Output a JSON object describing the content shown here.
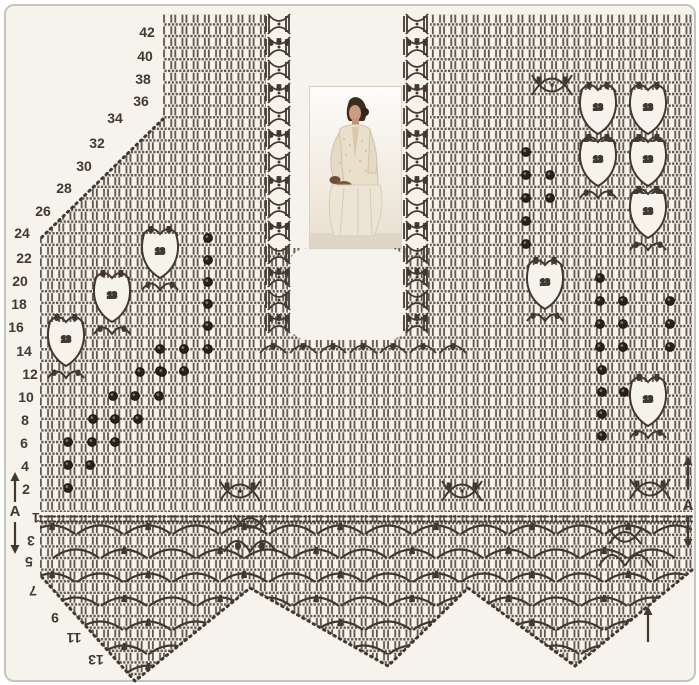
{
  "title": "Filet crochet vest pattern chart",
  "colors": {
    "paper": "#f6f3ed",
    "ink": "#42392e",
    "ink_soft": "#564c3e",
    "berry": "#2b2115",
    "berry_hl": "#8a7a5f",
    "frame": "#c7c4be"
  },
  "photo": {
    "description": "seated woman wearing a cream crochet cardigan"
  },
  "row_labels_left": [
    {
      "label": "42",
      "x": 147,
      "y": 32
    },
    {
      "label": "40",
      "x": 145,
      "y": 56
    },
    {
      "label": "38",
      "x": 143,
      "y": 79
    },
    {
      "label": "36",
      "x": 141,
      "y": 101
    },
    {
      "label": "34",
      "x": 115,
      "y": 118
    },
    {
      "label": "32",
      "x": 97,
      "y": 143
    },
    {
      "label": "30",
      "x": 84,
      "y": 166
    },
    {
      "label": "28",
      "x": 64,
      "y": 188
    },
    {
      "label": "26",
      "x": 43,
      "y": 211
    },
    {
      "label": "24",
      "x": 22,
      "y": 233
    },
    {
      "label": "22",
      "x": 24,
      "y": 258
    },
    {
      "label": "20",
      "x": 20,
      "y": 281
    },
    {
      "label": "18",
      "x": 19,
      "y": 304
    },
    {
      "label": "16",
      "x": 16,
      "y": 327
    },
    {
      "label": "14",
      "x": 24,
      "y": 351
    },
    {
      "label": "12",
      "x": 30,
      "y": 374
    },
    {
      "label": "10",
      "x": 26,
      "y": 397
    },
    {
      "label": "8",
      "x": 25,
      "y": 420
    },
    {
      "label": "6",
      "x": 24,
      "y": 443
    },
    {
      "label": "4",
      "x": 25,
      "y": 466
    },
    {
      "label": "2",
      "x": 26,
      "y": 489
    }
  ],
  "row_labels_bottom": [
    {
      "label": "1",
      "x": 36,
      "y": 518
    },
    {
      "label": "3",
      "x": 31,
      "y": 541
    },
    {
      "label": "5",
      "x": 29,
      "y": 562
    },
    {
      "label": "7",
      "x": 33,
      "y": 591
    },
    {
      "label": "9",
      "x": 55,
      "y": 618
    },
    {
      "label": "11",
      "x": 74,
      "y": 638
    },
    {
      "label": "13",
      "x": 96,
      "y": 660
    }
  ],
  "markers": {
    "left": {
      "label": "A",
      "x": 15,
      "label_y": 516,
      "up": [
        472,
        502
      ],
      "down": [
        522,
        554
      ]
    },
    "right": {
      "label": "A",
      "x": 688,
      "label_y": 510,
      "up": [
        456,
        490
      ],
      "down": [
        516,
        548
      ]
    },
    "corner_up_arrow": {
      "x": 648,
      "up": [
        606,
        642
      ]
    }
  },
  "outline": {
    "main_polygon": "163,14 692,14 692,512 40,512 40,239 163,119",
    "border_polygon": "40,515 692,515 692,570 575,666 468,588 388,666 250,588 135,681 40,575",
    "diag_edge": [
      [
        163,
        119
      ],
      [
        40,
        239
      ]
    ],
    "border_edge": [
      [
        692,
        570
      ],
      [
        575,
        666
      ],
      [
        468,
        588
      ],
      [
        388,
        666
      ],
      [
        250,
        588
      ],
      [
        135,
        681
      ],
      [
        40,
        575
      ]
    ],
    "channel": {
      "x": 266,
      "y": 12,
      "w": 164,
      "h": 236
    },
    "notch": {
      "x": 288,
      "y": 248,
      "w": 120,
      "h": 92,
      "r": 20
    },
    "chain_rows_y": [
      516.5,
      521.5
    ]
  },
  "motifs": {
    "fan_labels": {
      "top": [
        "5",
        "5"
      ],
      "center": "13",
      "bottom": [
        "6",
        "6"
      ]
    },
    "fans": [
      [
        160,
        256
      ],
      [
        112,
        300
      ],
      [
        66,
        344
      ],
      [
        598,
        112
      ],
      [
        648,
        112
      ],
      [
        598,
        164
      ],
      [
        648,
        164
      ],
      [
        648,
        216
      ],
      [
        545,
        287
      ],
      [
        648,
        404
      ]
    ],
    "bows": {
      "labels": [
        "5",
        "5"
      ],
      "positions": [
        [
          552,
          86
        ],
        [
          240,
          492
        ],
        [
          462,
          492
        ],
        [
          650,
          490
        ]
      ]
    },
    "specials": [
      {
        "x": 250,
        "y": 524,
        "labels": [
          "9",
          "9"
        ]
      },
      {
        "x": 625,
        "y": 538,
        "labels": []
      }
    ],
    "shell_columns": [
      {
        "x": 279,
        "y0": 24,
        "n": 14,
        "step": 23
      },
      {
        "x": 417,
        "y0": 24,
        "n": 14,
        "step": 23
      }
    ],
    "shell_labels": [
      "5",
      "3"
    ],
    "neck_shells": {
      "y": 353,
      "label": "5",
      "xs": [
        273,
        303,
        333,
        363,
        393,
        423,
        453
      ]
    },
    "berries": [
      [
        208,
        238
      ],
      [
        208,
        260
      ],
      [
        208,
        282
      ],
      [
        208,
        304
      ],
      [
        208,
        326
      ],
      [
        160,
        349
      ],
      [
        184,
        349
      ],
      [
        208,
        349
      ],
      [
        160,
        371
      ],
      [
        184,
        371
      ],
      [
        68,
        488
      ],
      [
        68,
        465
      ],
      [
        90,
        465
      ],
      [
        68,
        442
      ],
      [
        92,
        442
      ],
      [
        115,
        442
      ],
      [
        93,
        419
      ],
      [
        115,
        419
      ],
      [
        138,
        419
      ],
      [
        113,
        396
      ],
      [
        135,
        396
      ],
      [
        159,
        396
      ],
      [
        140,
        372
      ],
      [
        162,
        372
      ],
      [
        526,
        152
      ],
      [
        526,
        175
      ],
      [
        550,
        175
      ],
      [
        526,
        198
      ],
      [
        550,
        198
      ],
      [
        526,
        221
      ],
      [
        526,
        244
      ],
      [
        600,
        278
      ],
      [
        600,
        301
      ],
      [
        623,
        301
      ],
      [
        670,
        301
      ],
      [
        600,
        324
      ],
      [
        623,
        324
      ],
      [
        670,
        324
      ],
      [
        600,
        347
      ],
      [
        623,
        347
      ],
      [
        670,
        347
      ],
      [
        602,
        370
      ],
      [
        602,
        392
      ],
      [
        624,
        392
      ],
      [
        602,
        414
      ],
      [
        602,
        436
      ]
    ],
    "border_arcs": {
      "label": "7",
      "rows_y": [
        534,
        558,
        582,
        606,
        630,
        654,
        674
      ],
      "x0": 52,
      "x1": 688,
      "step": 48,
      "half_offset": 24
    }
  }
}
